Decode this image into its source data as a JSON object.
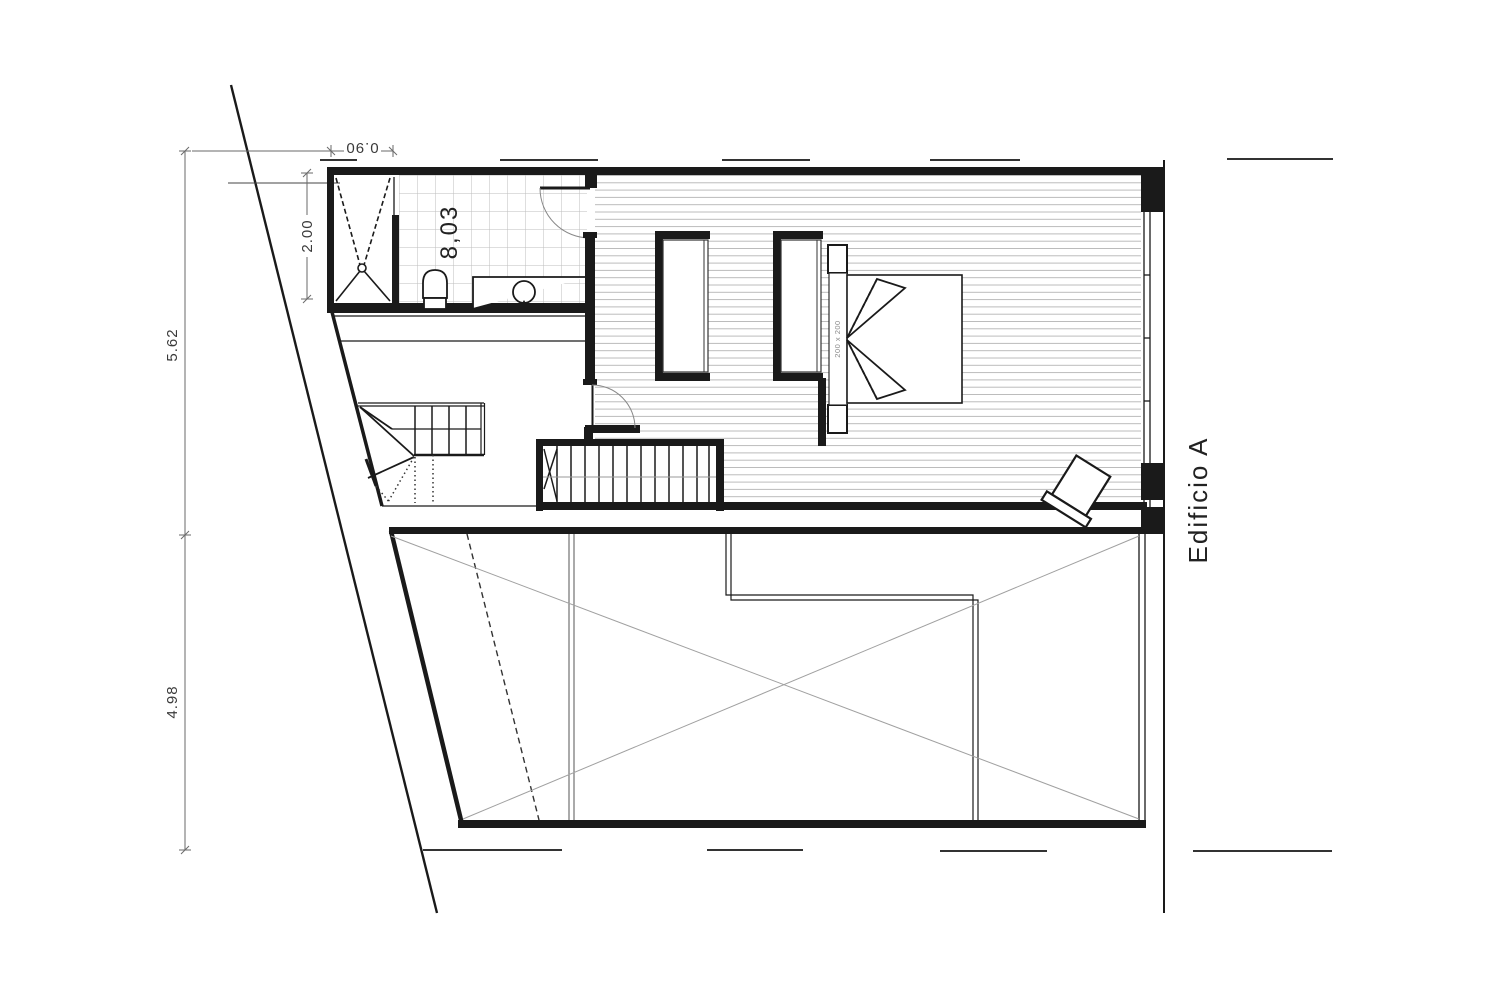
{
  "meta": {
    "type": "architectural-floor-plan",
    "sheet": "upper floor plan with double-height void"
  },
  "labels": {
    "building": "Edificio A",
    "bathroom_area": "8,03",
    "bed_size": "200 x 200"
  },
  "dimensions": {
    "left_upper": "5.62",
    "left_lower": "4.98",
    "bathroom_depth": "2.00",
    "shower_width": "0.90"
  },
  "colors": {
    "wall": "#1a1a1a",
    "dim-line": "#6a6a6a",
    "dim-text": "#3a3a3a",
    "hatch": "#ababab",
    "tile": "#bdbdbd",
    "void-cross": "#a0a0a0",
    "door-arc": "#888888",
    "bed-label": "#8a8a8a",
    "page-bg": "#ffffff"
  }
}
